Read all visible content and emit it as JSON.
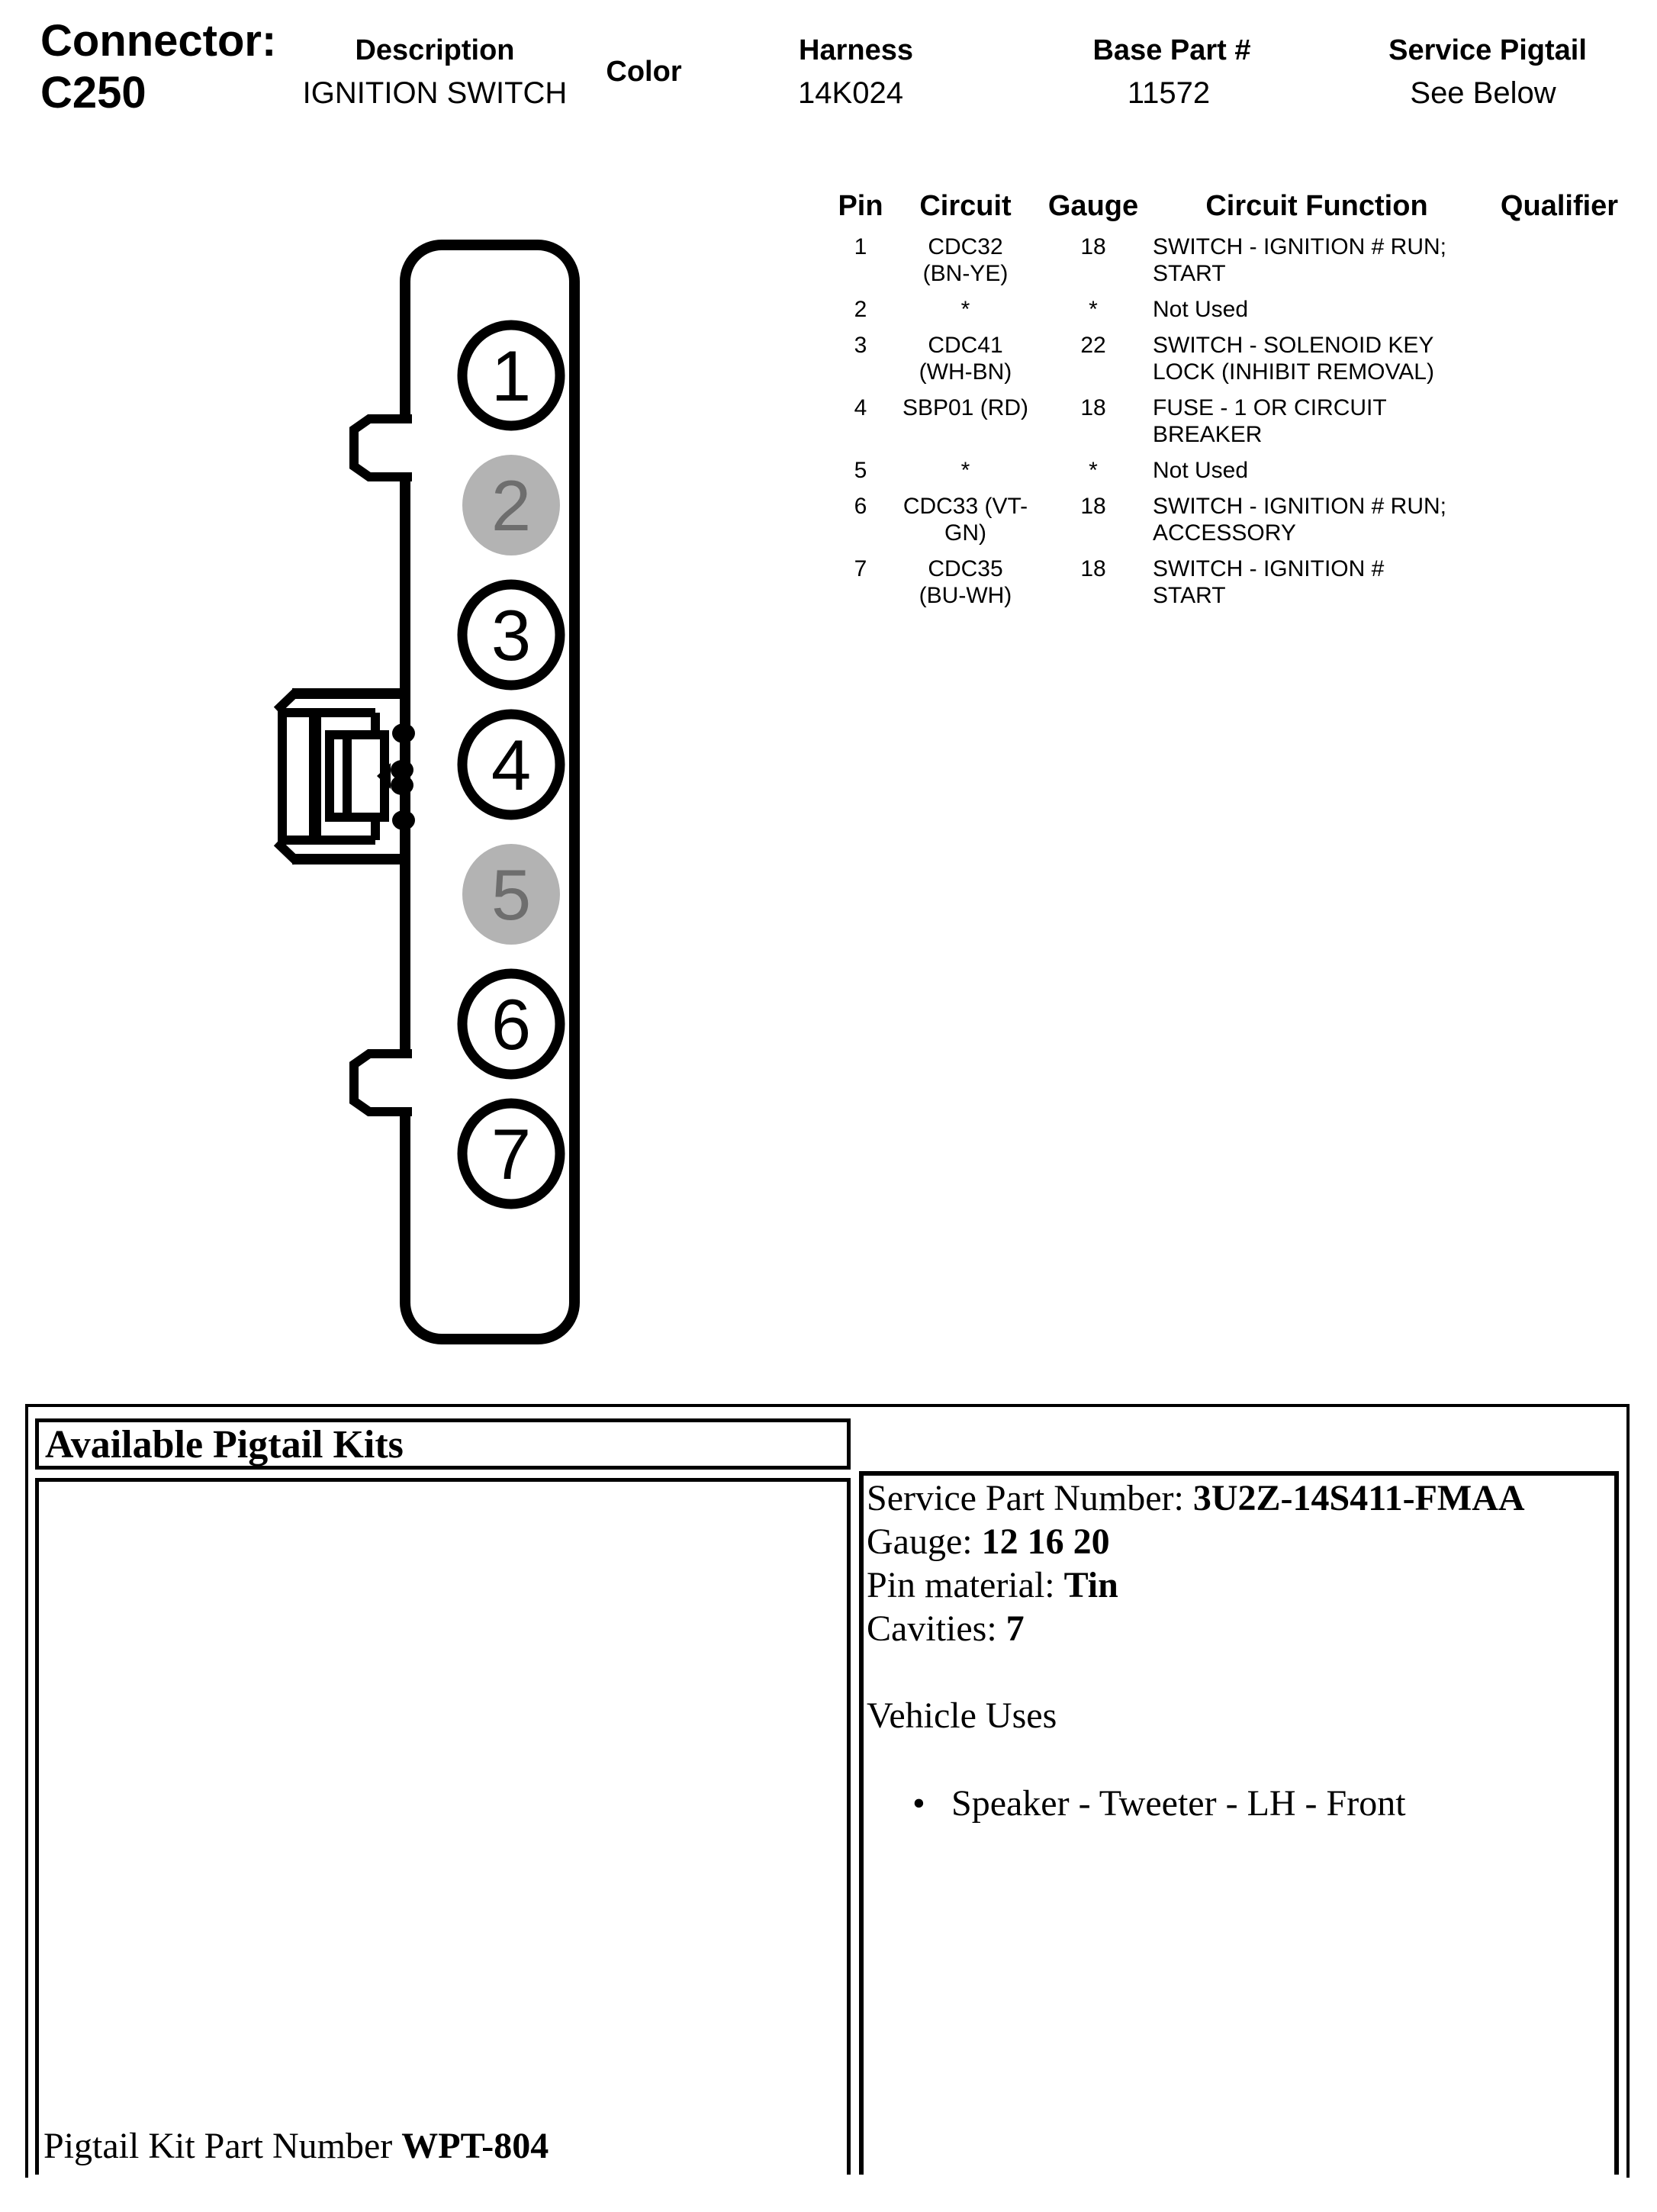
{
  "header": {
    "connector_label": "Connector:",
    "connector_id": "C250",
    "columns": [
      {
        "label": "Description",
        "value": "IGNITION SWITCH"
      },
      {
        "label": "Color",
        "value": ""
      },
      {
        "label": "Harness",
        "value": "14K024"
      },
      {
        "label": "Base Part #",
        "value": "11572"
      },
      {
        "label": "Service Pigtail",
        "value": "See Below"
      }
    ]
  },
  "pin_table": {
    "headers": [
      "Pin",
      "Circuit",
      "Gauge",
      "Circuit Function",
      "Qualifier"
    ],
    "rows": [
      {
        "pin": "1",
        "circuit": "CDC32\n(BN-YE)",
        "gauge": "18",
        "function": "SWITCH - IGNITION # RUN;\nSTART",
        "qualifier": ""
      },
      {
        "pin": "2",
        "circuit": "*",
        "gauge": "*",
        "function": "Not Used",
        "qualifier": ""
      },
      {
        "pin": "3",
        "circuit": "CDC41\n(WH-BN)",
        "gauge": "22",
        "function": "SWITCH - SOLENOID KEY\nLOCK (INHIBIT REMOVAL)",
        "qualifier": ""
      },
      {
        "pin": "4",
        "circuit": "SBP01 (RD)",
        "gauge": "18",
        "function": "FUSE - 1 OR CIRCUIT\nBREAKER",
        "qualifier": ""
      },
      {
        "pin": "5",
        "circuit": "*",
        "gauge": "*",
        "function": "Not Used",
        "qualifier": ""
      },
      {
        "pin": "6",
        "circuit": "CDC33 (VT-\nGN)",
        "gauge": "18",
        "function": "SWITCH - IGNITION # RUN;\nACCESSORY",
        "qualifier": ""
      },
      {
        "pin": "7",
        "circuit": "CDC35\n(BU-WH)",
        "gauge": "18",
        "function": "SWITCH - IGNITION #\nSTART",
        "qualifier": ""
      }
    ]
  },
  "diagram": {
    "pins": [
      {
        "number": "1",
        "shaded": false
      },
      {
        "number": "2",
        "shaded": true
      },
      {
        "number": "3",
        "shaded": false
      },
      {
        "number": "4",
        "shaded": false
      },
      {
        "number": "5",
        "shaded": true
      },
      {
        "number": "6",
        "shaded": false
      },
      {
        "number": "7",
        "shaded": false
      }
    ],
    "colors": {
      "line": "#000000",
      "shaded_pin_fill": "#b3b3b3",
      "shaded_pin_text": "#6e6e6e"
    }
  },
  "pigtail": {
    "title": "Available Pigtail Kits",
    "kit_label": "Pigtail Kit Part Number",
    "kit_value": "WPT-804",
    "details": [
      {
        "label": "Service Part Number:",
        "value": "3U2Z-14S411-FMAA"
      },
      {
        "label": "Gauge:",
        "value": "12 16 20"
      },
      {
        "label": "Pin material:",
        "value": "Tin"
      },
      {
        "label": "Cavities:",
        "value": "7"
      }
    ],
    "vehicle_uses_title": "Vehicle Uses",
    "vehicle_uses": [
      "Speaker - Tweeter - LH - Front"
    ],
    "bullet": "•"
  }
}
